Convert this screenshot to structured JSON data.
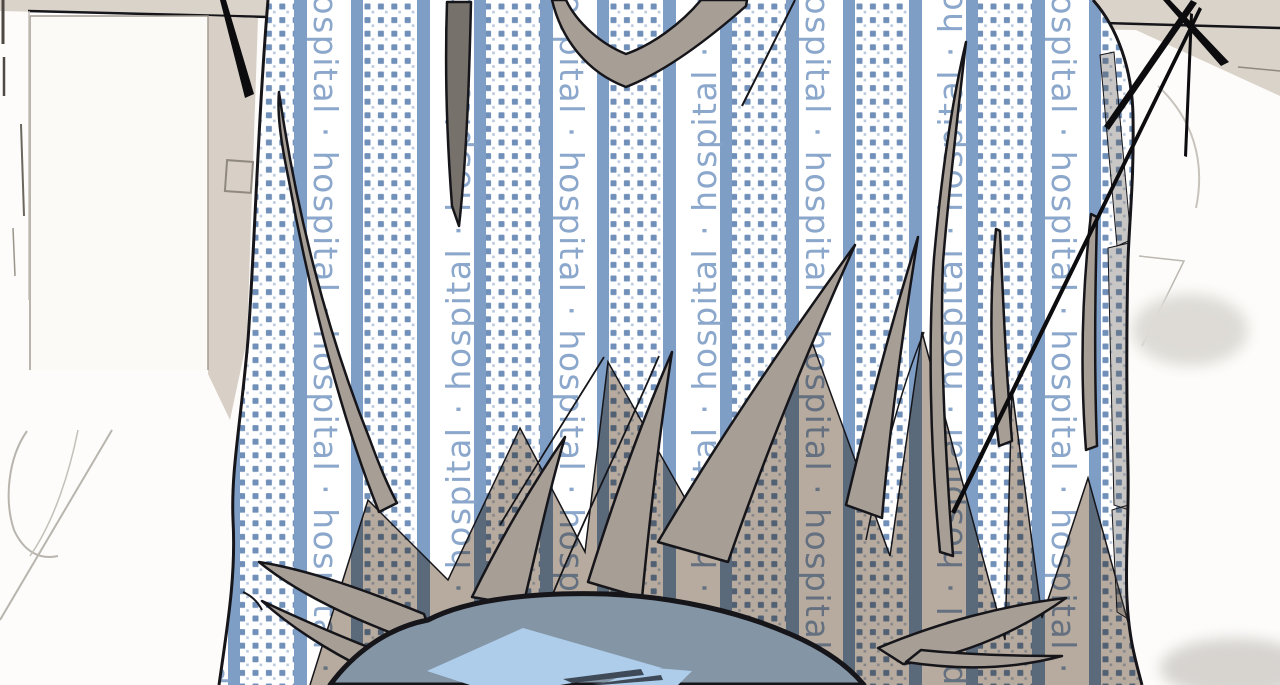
{
  "fabric": {
    "brand_word": "hospital",
    "separator": "·",
    "column_text": "hospital · hospital · hospital · hospital · hospital",
    "colors": {
      "base": "#ffffff",
      "stripe": "#7f9ec6",
      "dot": "#7190b9",
      "text": "#85a2c8",
      "shadow": "#b7ab9f"
    }
  },
  "art": {
    "colors": {
      "outline": "#15151a",
      "hair": "#a79e96",
      "hair_dark": "#76716b",
      "hair_translucent": "#57514b",
      "hair_darkest": "#3e4a57",
      "head": "#8495a6",
      "highlight": "#aecdeb",
      "wall": "#dad3ca",
      "bedding": "#fdfcfa",
      "furniture_line": "#a39c92"
    }
  }
}
